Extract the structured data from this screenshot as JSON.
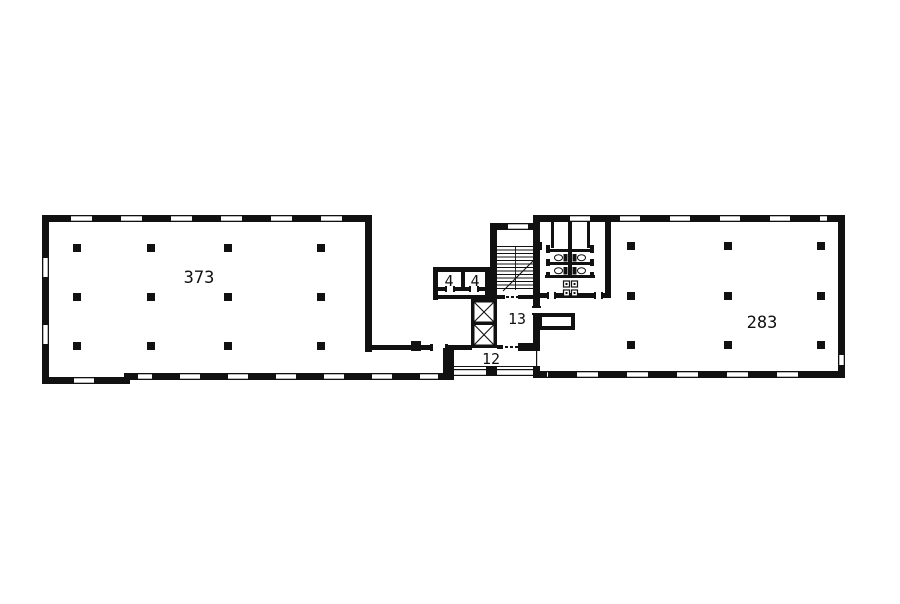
{
  "document": {
    "kind": "building-floor-plan",
    "page_background": "#ffffff"
  },
  "rooms": {
    "left_hall": {
      "label": "373"
    },
    "right_hall": {
      "label": "283"
    },
    "lobby_13": {
      "label": "13"
    },
    "corridor_12": {
      "label": "12"
    },
    "cell_4a": {
      "label": "4"
    },
    "cell_4b": {
      "label": "4"
    }
  },
  "colors": {
    "wall": "#111111",
    "background": "#ffffff"
  },
  "features": [
    "stairs",
    "elevator-shaft",
    "elevator-shaft",
    "toilets",
    "sinks",
    "column-grid-left-hall",
    "column-grid-right-hall",
    "window-openings",
    "door-openings"
  ]
}
